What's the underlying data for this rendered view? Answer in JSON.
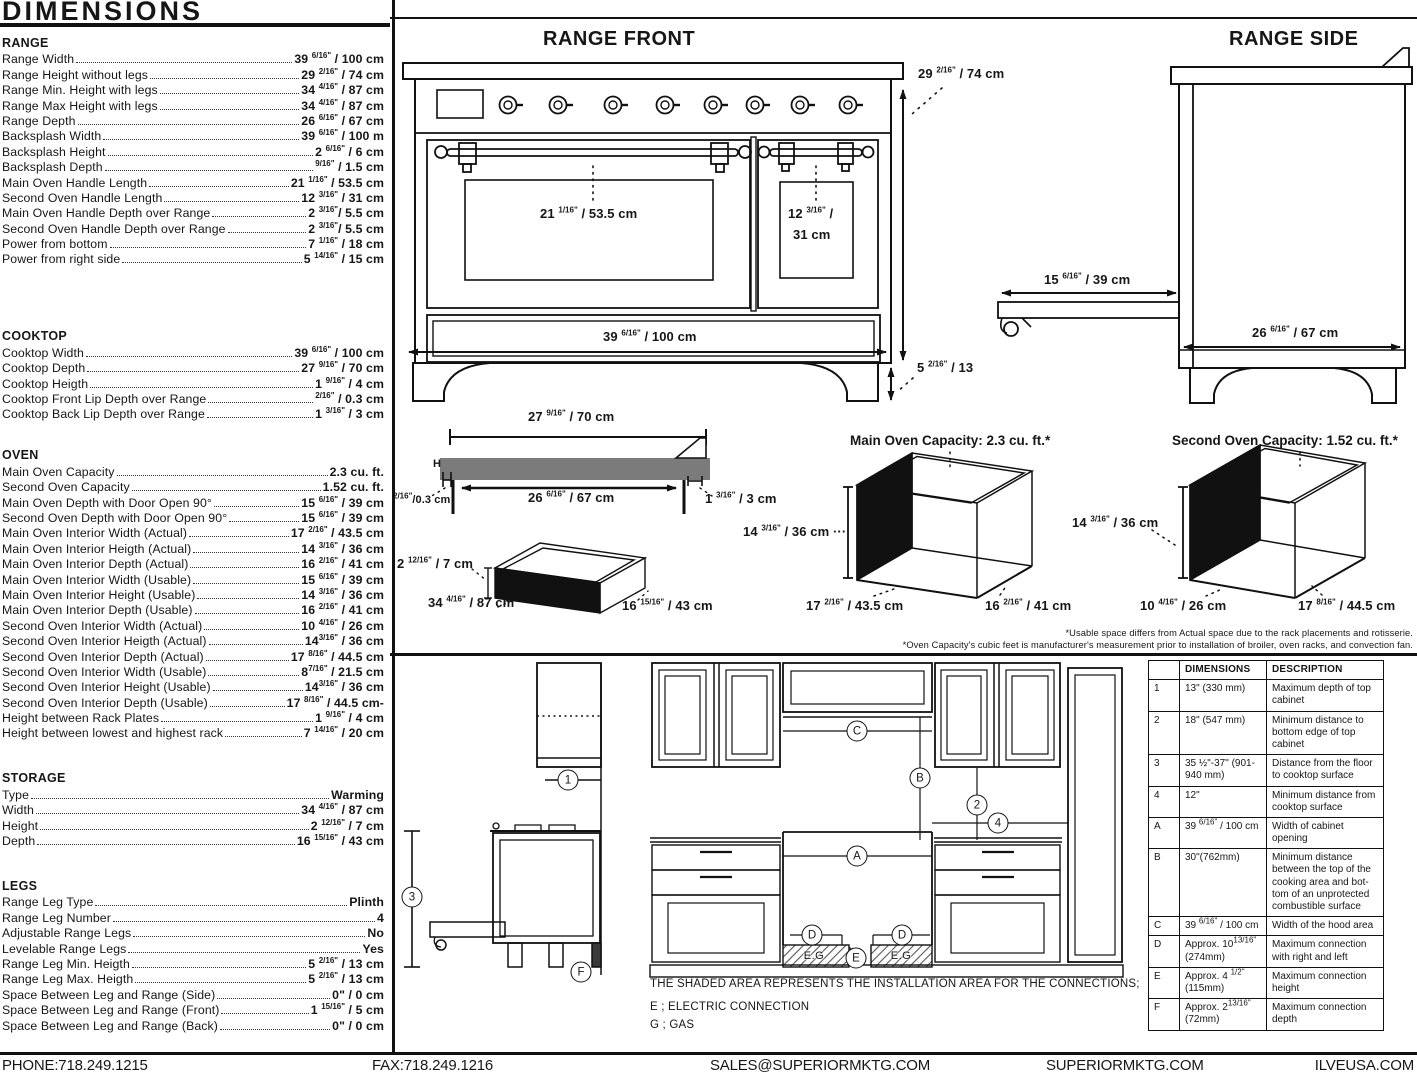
{
  "page": {
    "title": "DIMENSIONS"
  },
  "specs": {
    "sections": [
      {
        "title": "RANGE",
        "rows": [
          {
            "label": "Range Width",
            "value": "39 {{6/16\"}} / 100 cm"
          },
          {
            "label": "Range Height without legs",
            "value": "29 {{2/16\"}} / 74 cm"
          },
          {
            "label": "Range Min. Height with legs",
            "value": "34 {{4/16\"}} / 87 cm"
          },
          {
            "label": "Range Max Height with legs",
            "value": "34 {{4/16\"}} / 87 cm"
          },
          {
            "label": "Range Depth",
            "value": "26 {{6/16\"}} / 67 cm"
          },
          {
            "label": "Backsplash Width",
            "value": "39 {{6/16\"}} / 100 m"
          },
          {
            "label": "Backsplash Height",
            "value": "2 {{6/16\"}} / 6 cm"
          },
          {
            "label": "Backsplash Depth",
            "value": "{{9/16\"}} / 1.5 cm"
          },
          {
            "label": "Main Oven Handle Length",
            "value": "21 {{1/16\"}} / 53.5 cm"
          },
          {
            "label": "Second Oven Handle Length",
            "value": "12 {{3/16\"}} / 31 cm"
          },
          {
            "label": "Main Oven Handle Depth over Range",
            "value": "2 {{3/16\"}}/ 5.5 cm"
          },
          {
            "label": "Second Oven Handle Depth over Range",
            "value": "2 {{3/16\"}}/ 5.5 cm"
          },
          {
            "label": "Power from bottom",
            "value": "7 {{1/16\"}} / 18 cm"
          },
          {
            "label": "Power from right side",
            "value": "5 {{14/16\"}} / 15 cm"
          }
        ]
      },
      {
        "title": "COOKTOP",
        "rows": [
          {
            "label": "Cooktop Width",
            "value": "39 {{6/16\"}} / 100 cm"
          },
          {
            "label": "Cooktop Depth",
            "value": "27 {{9/16\"}} / 70 cm"
          },
          {
            "label": "Cooktop Heigth",
            "value": "1 {{9/16\"}} / 4 cm"
          },
          {
            "label": "Cooktop Front Lip Depth over Range",
            "value": "{{2/16\"}} / 0.3 cm"
          },
          {
            "label": "Cooktop Back Lip Depth over Range",
            "value": "1 {{3/16\"}} / 3 cm"
          }
        ]
      },
      {
        "title": "OVEN",
        "rows": [
          {
            "label": "Main Oven Capacity",
            "value": "2.3 cu. ft."
          },
          {
            "label": "Second Oven Capacity",
            "value": "1.52 cu. ft."
          },
          {
            "label": "Main Oven Depth with Door Open 90°",
            "value": "15 {{6/16\"}} / 39 cm"
          },
          {
            "label": "Second Oven Depth with Door Open 90°",
            "value": "15 {{6/16\"}} / 39 cm"
          },
          {
            "label": "Main Oven Interior Width (Actual)",
            "value": "17 {{2/16\"}} / 43.5 cm"
          },
          {
            "label": "Main Oven Interior Heigth (Actual)",
            "value": "14 {{3/16\"}} / 36 cm"
          },
          {
            "label": "Main Oven Interior Depth (Actual)",
            "value": "16 {{2/16\"}} / 41 cm"
          },
          {
            "label": "Main Oven Interior Width (Usable)",
            "value": "15 {{6/16\"}} / 39 cm"
          },
          {
            "label": "Main Oven Interior Height (Usable)",
            "value": "14 {{3/16\"}} / 36 cm"
          },
          {
            "label": "Main Oven Interior Depth (Usable)",
            "value": "16 {{2/16\"}} / 41 cm"
          },
          {
            "label": "Second Oven Interior Width (Actual)",
            "value": "10 {{4/16\"}} / 26 cm"
          },
          {
            "label": "Second Oven Interior Heigth (Actual)",
            "value": "14{{3/16\"}} / 36 cm"
          },
          {
            "label": "Second Oven Interior Depth (Actual)",
            "value": "17 {{8/16\"}} / 44.5 cm"
          },
          {
            "label": "Second Oven Interior Width (Usable)",
            "value": "8{{7/16\"}} / 21.5 cm"
          },
          {
            "label": "Second Oven Interior Height (Usable)",
            "value": "14{{3/16\"}} / 36 cm"
          },
          {
            "label": "Second Oven Interior Depth (Usable)",
            "value": "17 {{8/16\"}} / 44.5 cm-"
          },
          {
            "label": "Height between Rack Plates",
            "value": "1 {{9/16\"}} / 4 cm"
          },
          {
            "label": "Height between lowest and highest rack",
            "value": "7 {{14/16\"}} / 20 cm"
          }
        ]
      },
      {
        "title": "STORAGE",
        "rows": [
          {
            "label": "Type",
            "value": "Warming"
          },
          {
            "label": "Width",
            "value": "34 {{4/16\"}} / 87 cm"
          },
          {
            "label": "Height",
            "value": "2 {{12/16\"}} / 7 cm"
          },
          {
            "label": "Depth",
            "value": "16 {{15/16\"}} / 43 cm"
          }
        ]
      },
      {
        "title": "LEGS",
        "rows": [
          {
            "label": "Range Leg Type",
            "value": "Plinth"
          },
          {
            "label": "Range Leg Number",
            "value": "4"
          },
          {
            "label": "Adjustable Range Legs",
            "value": "No"
          },
          {
            "label": "Levelable Range Legs",
            "value": "Yes"
          },
          {
            "label": "Range Leg Min. Heigth",
            "value": "5 {{2/16\"}} / 13 cm"
          },
          {
            "label": "Range Leg Max. Heigth",
            "value": "5 {{2/16\"}} / 13 cm"
          },
          {
            "label": "Space Between Leg and Range (Side)",
            "value": "0\" / 0 cm"
          },
          {
            "label": "Space Between Leg and Range (Front)",
            "value": "1 {{15/16\"}} / 5 cm"
          },
          {
            "label": "Space Between Leg and Range (Back)",
            "value": "0\" / 0 cm"
          }
        ]
      }
    ]
  },
  "diagrams": {
    "range_front": {
      "title": "RANGE FRONT",
      "labels": {
        "height": "29 {{2/16\"}} / 74 cm",
        "main_handle": "21 {{1/16\"}} / 53.5 cm",
        "second_handle_1": "12 {{3/16\"}} /",
        "second_handle_2": "31 cm",
        "width": "39 {{6/16\"}} / 100 cm",
        "leg_height": "5 {{2/16\"}} / 13"
      }
    },
    "range_side": {
      "title": "RANGE SIDE",
      "labels": {
        "door_open": "15 {{6/16\"}} / 39 cm",
        "depth": "26 {{6/16\"}} / 67 cm"
      }
    },
    "cooktop_profile": {
      "labels": {
        "width": "27 {{9/16\"}} / 70 cm",
        "inner": "26 {{6/16\"}} / 67 cm",
        "front_lip": "{{2/16\"}}/0.3 cm",
        "back_lip": "1 {{3/16\"}} / 3 cm",
        "h_mark": "H"
      }
    },
    "drawer": {
      "labels": {
        "height": "2 {{12/16\"}} / 7 cm",
        "width": "34 {{4/16\"}} / 87 cm",
        "depth": "16 {{15/16\"}} / 43 cm"
      }
    },
    "main_oven": {
      "title": "Main Oven Capacity: 2.3 cu. ft.*",
      "labels": {
        "height": "14 {{3/16\"}} / 36 cm ···",
        "width": "17 {{2/16\"}} / 43.5 cm",
        "depth": "16 {{2/16\"}} / 41 cm"
      }
    },
    "second_oven": {
      "title": "Second Oven Capacity: 1.52 cu. ft.*",
      "labels": {
        "height": "14 {{3/16\"}} / 36 cm",
        "width": "10 {{4/16\"}} / 26 cm",
        "depth": "17 {{8/16\"}} / 44.5 cm"
      }
    },
    "footnotes": [
      "*Usable space differs from Actual space due to the rack placements and rotisserie.",
      "*Oven Capacity's cubic feet is manufacturer's measurement prior to installation of broiler, oven racks, and convection fan."
    ]
  },
  "installation": {
    "callouts": {
      "n1": "1",
      "n2": "2",
      "n3": "3",
      "n4": "4",
      "A": "A",
      "B": "B",
      "C": "C",
      "D": "D",
      "E": "E",
      "F": "F"
    },
    "eg_label": "E.G",
    "note": "THE SHADED AREA REPRESENTS THE INSTALLATION AREA FOR THE CONNECTIONS;",
    "legend": [
      "E ; ELECTRIC CONNECTION",
      "G ; GAS"
    ],
    "table": {
      "headers": [
        "",
        "DIMENSIONS",
        "DESCRIPTION"
      ],
      "rows": [
        {
          "id": "1",
          "dim": "13\" (330 mm)",
          "desc": "Maximum depth of top cabinet"
        },
        {
          "id": "2",
          "dim": "18\" (547 mm)",
          "desc": "Minimum distance to bottom edge of top cabinet"
        },
        {
          "id": "3",
          "dim": "35 ½\"-37\" (901-940 mm)",
          "desc": "Distance from the floor to cooktop surface"
        },
        {
          "id": "4",
          "dim": "12\"",
          "desc": "Minimum distance from cooktop surface"
        },
        {
          "id": "A",
          "dim": "39 {{6/16\"}} / 100 cm",
          "desc": "Width of cabinet opening"
        },
        {
          "id": "B",
          "dim": "30\"(762mm)",
          "desc": "Minimum distance between the top of the cooking area and bot- tom of an unprotected combustible surface"
        },
        {
          "id": "C",
          "dim": "39 {{6/16\"}} / 100 cm",
          "desc": "Width of the hood area"
        },
        {
          "id": "D",
          "dim": "Approx. 10{{13/16\"}} (274mm)",
          "desc": "Maximum connection with right and left"
        },
        {
          "id": "E",
          "dim": "Approx. 4 {{1/2\"}} (115mm)",
          "desc": "Maximum connection height"
        },
        {
          "id": "F",
          "dim": "Approx. 2{{13/16\"}} (72mm)",
          "desc": "Maximum connection depth"
        }
      ]
    }
  },
  "footer": {
    "items": [
      "PHONE:718.249.1215",
      "FAX:718.249.1216",
      "SALES@SUPERIORMKTG.COM",
      "SUPERIORMKTG.COM",
      "ILVEUSA.COM"
    ]
  }
}
